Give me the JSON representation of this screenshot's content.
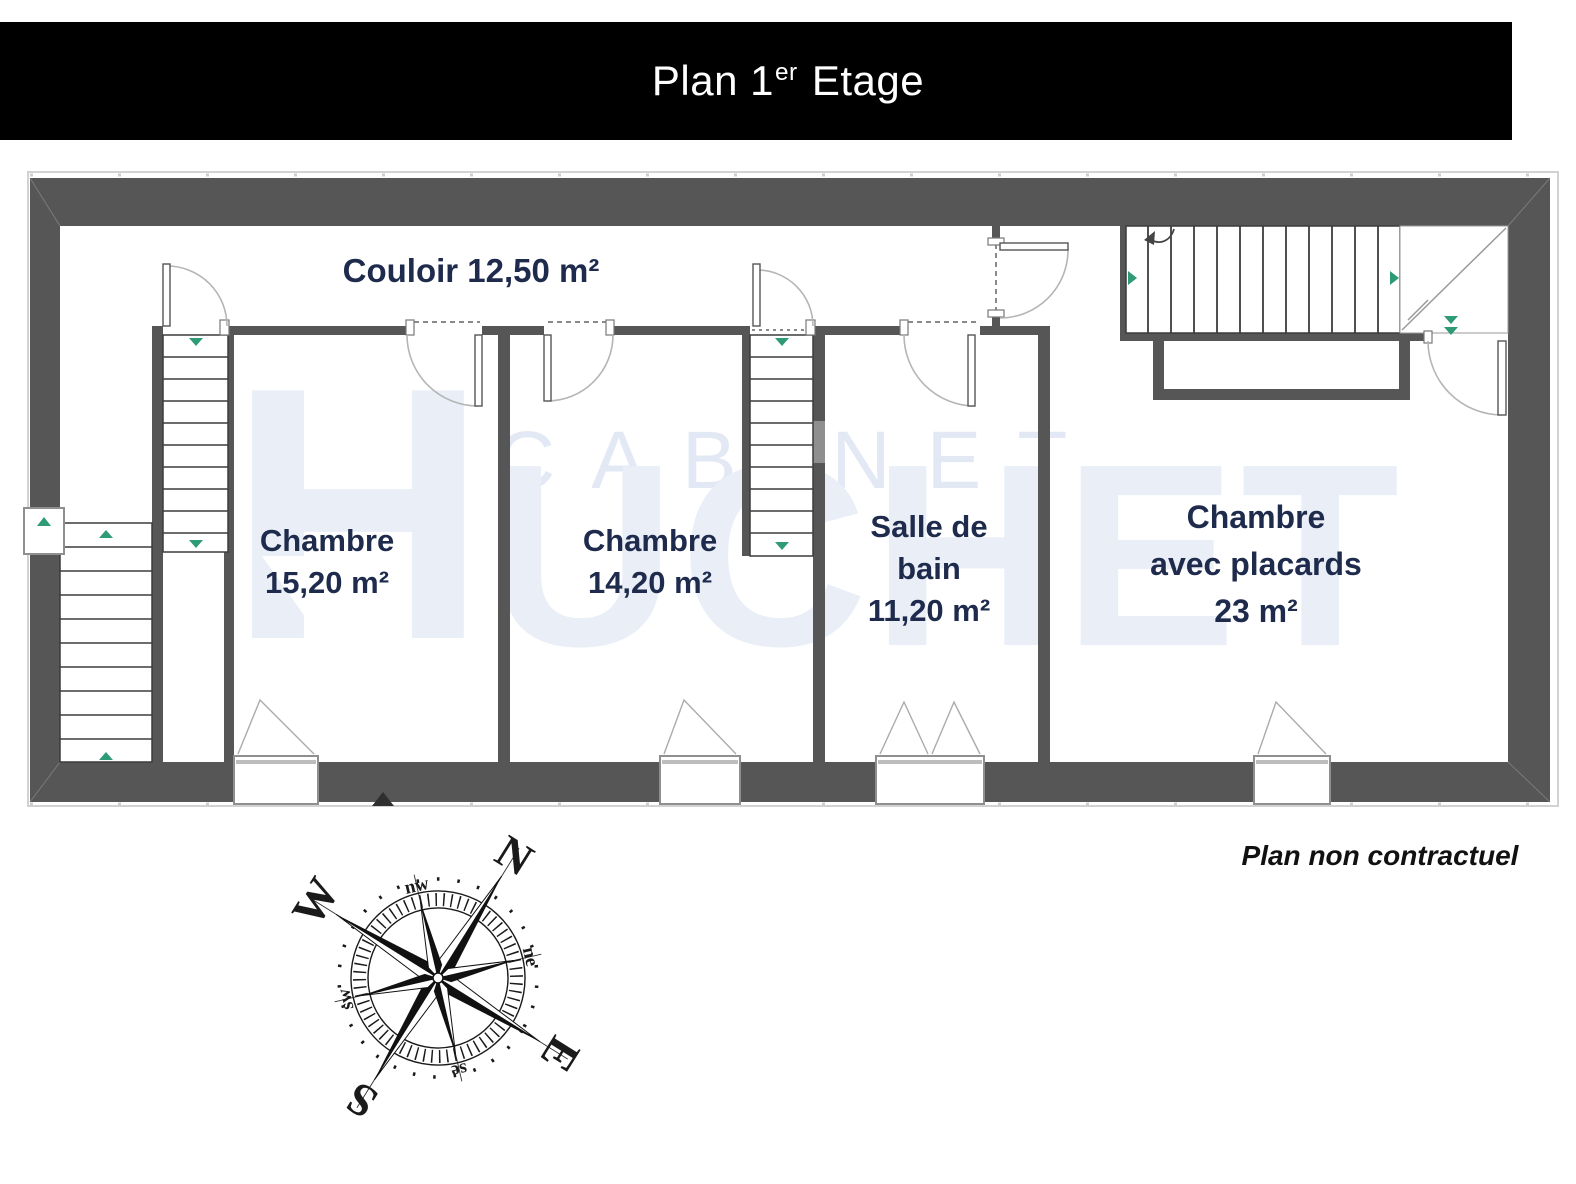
{
  "title": {
    "prefix": "Plan 1",
    "superscript": "er",
    "suffix": " Etage"
  },
  "rooms": [
    {
      "id": "couloir",
      "lines": [
        "Couloir 12,50 m²"
      ],
      "x": 471,
      "top": 250,
      "size": 33,
      "line_height": 42
    },
    {
      "id": "chambre-1",
      "lines": [
        "Chambre",
        "15,20 m²"
      ],
      "x": 327,
      "top": 520,
      "size": 31,
      "line_height": 42
    },
    {
      "id": "chambre-2",
      "lines": [
        "Chambre",
        "14,20 m²"
      ],
      "x": 650,
      "top": 520,
      "size": 31,
      "line_height": 42
    },
    {
      "id": "salle-de-bain",
      "lines": [
        "Salle de",
        "bain",
        "11,20 m²"
      ],
      "x": 929,
      "top": 506,
      "size": 31,
      "line_height": 42
    },
    {
      "id": "chambre-avec-placards",
      "lines": [
        "Chambre",
        "avec placards",
        "23 m²"
      ],
      "x": 1256,
      "top": 494,
      "size": 32,
      "line_height": 47
    }
  ],
  "watermark": {
    "line1": "CABINET",
    "line2_initial": "H",
    "line2_rest": "UCHET"
  },
  "footer": {
    "note": "Plan non contractuel"
  },
  "compass": {
    "n": "N",
    "e": "E",
    "s": "S",
    "w": "W",
    "nw": "nw",
    "ne": "ne",
    "se": "se",
    "sw": "sw"
  },
  "colors": {
    "title_bar_bg": "#000000",
    "title_text": "#ffffff",
    "wall": "#565656",
    "wall_light": "#8f8f8f",
    "room_label": "#1e2b4c",
    "watermark": "#e9eef7",
    "watermark_outline": "#e3e9f4",
    "arrow_green": "#2f9a78",
    "door_arc": "#b5b5b5",
    "stair_line": "#3c3c3c",
    "footer_text": "#111111",
    "compass": "#1a1a1a"
  }
}
